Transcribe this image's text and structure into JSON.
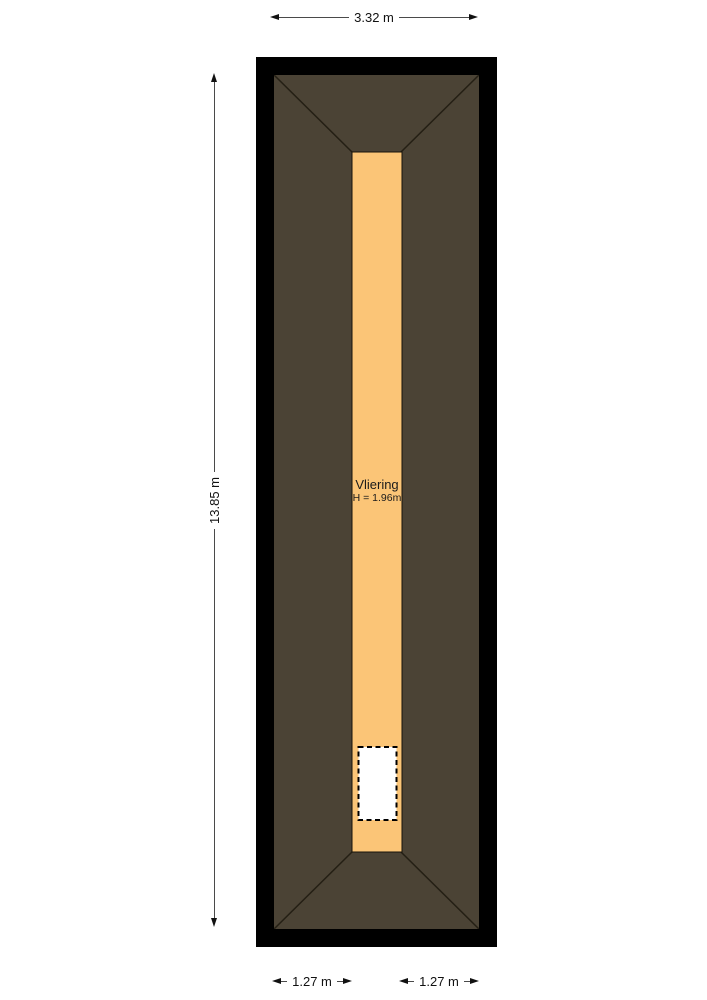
{
  "floorplan": {
    "room": {
      "label": "Vliering",
      "height_label": "H = 1.96m"
    },
    "colors": {
      "wall": "#000000",
      "roof": "#4B4335",
      "floor": "#FBC577",
      "hatch": "#FFFFFF"
    }
  },
  "dimensions": {
    "width_top": "3.32 m",
    "height_left": "13.85 m",
    "bottom_left": "1.27 m",
    "bottom_right": "1.27 m"
  }
}
